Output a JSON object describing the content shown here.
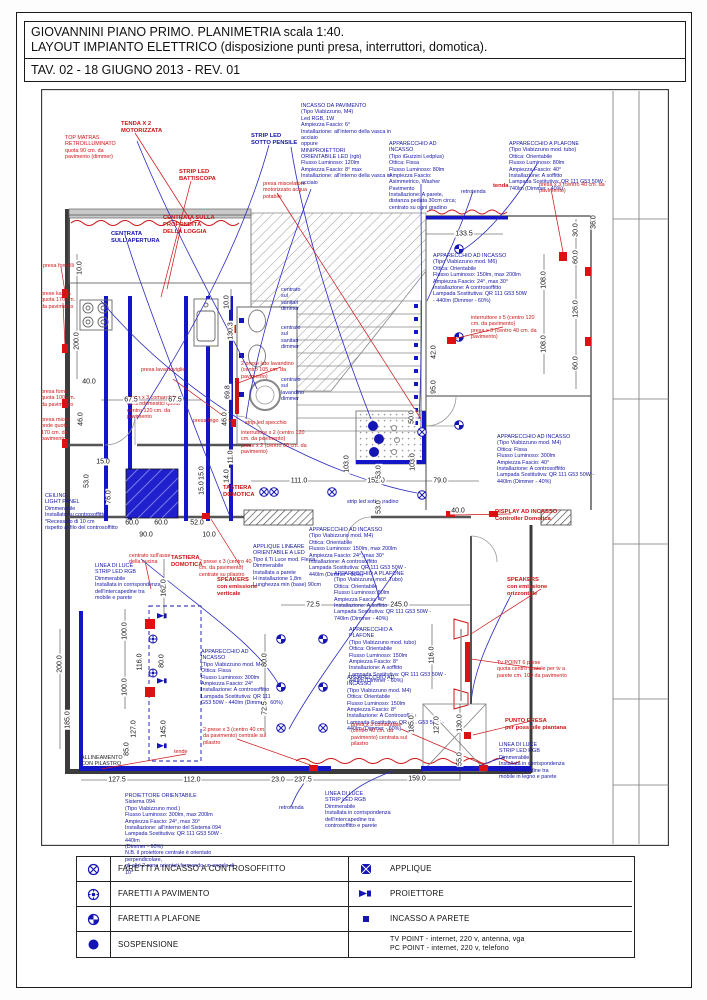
{
  "page": {
    "title_line1": "GIOVANNINI PIANO PRIMO. PLANIMETRIA scala 1:40.",
    "title_line2": "LAYOUT IMPIANTO ELETTRICO (disposizione punti presa, interruttori, domotica).",
    "title_line3": "TAV. 02 - 18 GIUGNO 2013 - REV. 01"
  },
  "colors": {
    "annotation_red": "#cc1414",
    "annotation_blue": "#1515a8",
    "strip_led_blue": "#1515c8",
    "wall_gray": "#4a4a4a"
  },
  "legend": {
    "rows": [
      {
        "symbol": "faretto-incasso-controsoffitto-icon",
        "label": "FARETTI A INCASSO A CONTROSOFFITTO"
      },
      {
        "symbol": "faretto-pavimento-icon",
        "label": "FARETTI A PAVIMENTO"
      },
      {
        "symbol": "faretto-plafone-icon",
        "label": "FARETTI A PLAFONE"
      },
      {
        "symbol": "sospensione-icon",
        "label": "SOSPENSIONE"
      },
      {
        "symbol": "applique-icon",
        "label": "APPLIQUE"
      },
      {
        "symbol": "proiettore-icon",
        "label": "PROIETTORE"
      },
      {
        "symbol": "incasso-parete-icon",
        "label": "INCASSO A PARETE"
      },
      {
        "symbol": "none",
        "label": "TV POINT - internet, 220 v, antenna, vga\nPC POINT - internet, 220 v, telefono"
      }
    ]
  },
  "plan": {
    "labels": [
      {
        "t": "TENDA X 2\nMOTORIZZATA",
        "x": 80,
        "y": 32,
        "c": "red b"
      },
      {
        "t": "STRIP LED\nBATTISCOPA",
        "x": 138,
        "y": 80,
        "c": "red b"
      },
      {
        "t": "TOP MATRAS\nRETROILLUMINATO\nquota 90 cm. da\npavimento (dimmer)",
        "x": 24,
        "y": 46,
        "c": "red"
      },
      {
        "t": "presa miscelatore\nmotorizzato acqua\npotabile",
        "x": 222,
        "y": 92,
        "c": "red"
      },
      {
        "t": "CENTRATA SULLA\nPROFONDITÀ\nDELLA LOGGIA",
        "x": 122,
        "y": 126,
        "c": "red b"
      },
      {
        "t": "CENTRATA\nSULL'APERTURA",
        "x": 70,
        "y": 142,
        "c": "blue b"
      },
      {
        "t": "STRIP LED\nSOTTO PENSILE",
        "x": 210,
        "y": 44,
        "c": "blue b"
      },
      {
        "t": "presa fornelli",
        "x": 2,
        "y": 174,
        "c": "red"
      },
      {
        "t": "prese kappa\nquota 170 cm.\nda pavimento",
        "x": 0,
        "y": 202,
        "c": "red"
      },
      {
        "t": "presa forno\nquota 100 cm.\nda pavimento",
        "x": 0,
        "y": 300,
        "c": "red"
      },
      {
        "t": "presa micro\nonde quota\n170 cm. da\npavimento",
        "x": 0,
        "y": 328,
        "c": "red"
      },
      {
        "t": "presa lavastoviglie",
        "x": 100,
        "y": 278,
        "c": "red"
      },
      {
        "t": "presa frigo",
        "x": 152,
        "y": 329,
        "c": "red"
      },
      {
        "t": "presa x 3 comandata\nelettrodomestici quota\ncentro 120 cm. da\npavimento",
        "x": 86,
        "y": 306,
        "c": "red"
      },
      {
        "t": "2 prese lato lavandino\n(centro 105 cm. da\npavimento)",
        "x": 200,
        "y": 272,
        "c": "red"
      },
      {
        "t": "strip led specchio",
        "x": 204,
        "y": 331,
        "c": "red"
      },
      {
        "t": "interruttore x 2 (centro 120\ncm. da pavimento)\nprese x 2 (centro 60 cm. da\npavimento)",
        "x": 200,
        "y": 341,
        "c": "red"
      },
      {
        "t": "centrato\nsul\nsanitari\ndimmer",
        "x": 240,
        "y": 198,
        "c": "blue"
      },
      {
        "t": "centrato\nsul\nsanitari\ndimmer",
        "x": 240,
        "y": 236,
        "c": "blue"
      },
      {
        "t": "centrato\nsul\nlavandino\ndimmer",
        "x": 240,
        "y": 288,
        "c": "blue"
      },
      {
        "t": "INCASSO DA PAVIMENTO\n(Tipo Viabizzuno, M4)\nLed RGB, 1W\nAmpiezza Fascio: 6°\nInstallazione: all'interno della vasca in\nacciaio\noppure\nMINIPROIETTORI\nORIENTABILE LED (rgb)\nFlusso Luminoso: 120lm\nAmpiezza Fascio: 8° max\nInstallazione: all'interno della vasca in\nacciaio",
        "x": 260,
        "y": 14,
        "c": "blue"
      },
      {
        "t": "APPARECCHIO AD\nINCASSO\n(Tipo iGuzzini Ledplus)\nOttica: Fissa\nFlusso Luminoso: 80lm\nAmpiezza Fascio:\nAsimmetrico, Washer\nPavimento\nInstallazione: A parete,\ndistanza pedata 30cm circa;\ncentrato su ogni gradino",
        "x": 348,
        "y": 52,
        "c": "blue"
      },
      {
        "t": "APPARECCHIO A PLAFONE\n(Tipo Viabizzuno mod. tubo)\nOttica: Orientabile\nFlusso Luminoso: 80lm\nAmpiezza Fascio: 40°\nInstallazione: A soffitto\nLampada Sostitutiva: QR 111 G53 50W - 740lm (Dimmer - 40%)",
        "x": 468,
        "y": 52,
        "c": "blue"
      },
      {
        "t": "retrotenda",
        "x": 420,
        "y": 100,
        "c": "blue"
      },
      {
        "t": "tenda",
        "x": 452,
        "y": 94,
        "c": "red b"
      },
      {
        "t": "presa x 3 (centro 40 cm. da\npavimento)",
        "x": 498,
        "y": 93,
        "c": "red"
      },
      {
        "t": "APPARECCHIO AD INCASSO\n(Tipo Viabizzuno mod. M6)\nOttica: Orientabile\nFlusso Luminoso: 150lm, max 200lm\nAmpiezza Fascio: 24°, max 30°\nInstallazione: A controsoffitto\nLampada Sostitutiva: QR 111 G53 50W\n- 440lm (Dimmer - 60%)",
        "x": 392,
        "y": 164,
        "c": "blue"
      },
      {
        "t": "interruttore x 5 (centro 120\ncm. da pavimento)\npresa x 3 (centro 40 cm. da\npavimento)",
        "x": 430,
        "y": 226,
        "c": "red"
      },
      {
        "t": "APPARECCHIO AD INCASSO\n(Tipo Viabizzuno mod. M4)\nOttica: Fissa\nFlusso Luminoso: 300lm\nAmpiezza Fascio: 40°\nInstallazione: A controsoffitto\nLampada Sostitutiva: QR 111 G53 50W - 440lm (Dimmer - 40%)",
        "x": 456,
        "y": 345,
        "c": "blue"
      },
      {
        "t": "strip led sotto gradino",
        "x": 306,
        "y": 410,
        "c": "blue"
      },
      {
        "t": "DISPLAY AD INCASSO\nController Domotica",
        "x": 454,
        "y": 420,
        "c": "red b"
      },
      {
        "t": "APPARECCHIO AD INCASSO\n(Tipo Viabizzuno mod. M4)\nOttica: Orientabile\nFlusso Luminoso: 150lm, max 200lm\nAmpiezza Fascio: 24°, max 30°\nInstallazione: A controsoffitto\nLampada Sostitutiva: QR 111 G53 50W - 440lm (Dimmer - 60%)",
        "x": 268,
        "y": 438,
        "c": "blue"
      },
      {
        "t": "APPLIQUE LINEARE\nORIENTABILE A LED\nTipo il.Ti Luce mod. Flexia\nDimmerabile\nInstallata a parete\nH installazione 1,8m\nLunghezza min (base) 90cm",
        "x": 212,
        "y": 455,
        "c": "blue"
      },
      {
        "t": "CEILING\nLIGHT PANEL\nDimmerabile\nInstallato su controsoffitto\n*Recessato di 10 cm\nrispetto al filo del controsoffitto",
        "x": 4,
        "y": 404,
        "c": "blue"
      },
      {
        "t": "LINEA DI LUCE\nSTRIP LED RGB\nDimmerabile\nInstallata in corrispondenza\ndell'intercapedine tra\nmobile e parete",
        "x": 54,
        "y": 474,
        "c": "blue"
      },
      {
        "t": "centrato sull'asse\ndella cucina",
        "x": 88,
        "y": 464,
        "c": "red"
      },
      {
        "t": "TASTIERA\nDOMOTICA",
        "x": 182,
        "y": 396,
        "c": "red b"
      },
      {
        "t": "TASTIERA\nDOMOTICA",
        "x": 130,
        "y": 466,
        "c": "red b"
      },
      {
        "t": "2 prese x 3 (centro 40\ncm. da pavimento)\ncentrate su pilastro",
        "x": 158,
        "y": 470,
        "c": "red"
      },
      {
        "t": "SPEAKERS\ncon emissione\nverticale",
        "x": 176,
        "y": 488,
        "c": "red b"
      },
      {
        "t": "APPARECCHIO A PLAFONE\n(Tipo Viabizzuno mod. Tubo)\nOttica: Orientabile\nFlusso Luminoso: 80lm\nAmpiezza Fascio: 40°\nInstallazione: A soffitto\nLampada Sostitutiva: QR 111 G53 50W - 740lm (Dimmer - 40%)",
        "x": 293,
        "y": 482,
        "c": "blue"
      },
      {
        "t": "APPARECCHIO A\nPLAFONE\n(Tipo Viabizzuno mod. tubo)\nOttica: Orientabile\nFlusso Luminoso: 150lm\nAmpiezza Fascio: 8°\nInstallazione: A soffitto\nLampada Sostitutiva: QR 111 G53 50W - 440lm (Dimmer - 60%)",
        "x": 308,
        "y": 538,
        "c": "blue"
      },
      {
        "t": "APPARECCHIO AD\nINCASSO\n(Tipo Viabizzuno mod. M4)\nOttica: Orientabile\nFlusso Luminoso: 150lm\nAmpiezza Fascio: 8°\nInstallazione: A Controsoffitto\nLampada Sostitutiva: QR 111 G53 50W - 440lm (Dimmer - 60%)",
        "x": 306,
        "y": 586,
        "c": "blue"
      },
      {
        "t": "APPARECCHIO AD\nINCASSO\n(Tipo Viabizzuno mod. M4)\nOttica: Fissa\nFlusso Luminoso: 300lm\nAmpiezza Fascio: 24°\nInstallazione: A controsoffitto\nLampada Sostitutiva: QR 111\nG53 50W - 440lm (Dimmer - 60%)",
        "x": 160,
        "y": 560,
        "c": "blue"
      },
      {
        "t": "SPEAKERS\ncon emissione\norizzontale",
        "x": 466,
        "y": 488,
        "c": "red b"
      },
      {
        "t": "Tv POINT 6 prese\nquota centro scatole per tv a\nparete cm. 100 da pavimento",
        "x": 456,
        "y": 571,
        "c": "red"
      },
      {
        "t": "PUNTO PRESA\nper possibile piantana",
        "x": 464,
        "y": 629,
        "c": "red b"
      },
      {
        "t": "LINEA DI LUCE\nSTRIP LED RGB\nDimmerabile\nInstallata in corrispondenza\ndell'intercapedine tra\nmobile in legno e parete",
        "x": 458,
        "y": 653,
        "c": "blue"
      },
      {
        "t": "presa x 3 comandate\n(centro 40 cm. da\npavimento) centrata sul\npilastro",
        "x": 310,
        "y": 633,
        "c": "red"
      },
      {
        "t": "2 prese x 3 (centro 40 cm.\nda pavimento) centrale sul\npilastro",
        "x": 162,
        "y": 638,
        "c": "red"
      },
      {
        "t": "tende",
        "x": 133,
        "y": 660,
        "c": "red"
      },
      {
        "t": "ALLINEAMENTO\nCON PILASTRO",
        "x": 40,
        "y": 666,
        "c": "black"
      },
      {
        "t": "PROIETTORE ORIENTABILE\nSistema 094\n(Tipo Viabizzuno mod.)\nFlusso Luminoso: 300lm, max 200lm\nAmpiezza Fascio: 24°, max 30°\nInstallazione: all'interno del Sistema 094\nLampada Sostitutiva: QR 111 G53 50W - 440lm\n(Dimmer - 60%)\nN.B. il proiettore centrale è orientato perpendicolare,\ngli altri 2 sono orientati formando un angolo di 10°",
        "x": 84,
        "y": 704,
        "c": "blue"
      },
      {
        "t": "retrotenda",
        "x": 238,
        "y": 716,
        "c": "blue"
      },
      {
        "t": "LINEA DI LUCE\nSTRIP LED RGB\nDimmerabile\nInstallata in corrispondenza\ndell'intercapedine tra\ncontrosoffitto e parete",
        "x": 284,
        "y": 702,
        "c": "blue"
      }
    ],
    "dims": [
      {
        "t": "10.0",
        "x": 39,
        "y": 179,
        "r": 1
      },
      {
        "t": "200.0",
        "x": 36,
        "y": 252,
        "r": 1
      },
      {
        "t": "40.0",
        "x": 48,
        "y": 293
      },
      {
        "t": "67.5",
        "x": 90,
        "y": 311
      },
      {
        "t": "67.5",
        "x": 134,
        "y": 311
      },
      {
        "t": "46.0",
        "x": 40,
        "y": 330,
        "r": 1
      },
      {
        "t": "46.0",
        "x": 184,
        "y": 330,
        "r": 1
      },
      {
        "t": "10.0",
        "x": 186,
        "y": 213,
        "r": 1
      },
      {
        "t": "130.3",
        "x": 190,
        "y": 242,
        "r": 1
      },
      {
        "t": "69.8",
        "x": 187,
        "y": 303,
        "r": 1
      },
      {
        "t": "11.0",
        "x": 190,
        "y": 368,
        "r": 1
      },
      {
        "t": "15.0",
        "x": 62,
        "y": 373
      },
      {
        "t": "53.0",
        "x": 46,
        "y": 392,
        "r": 1
      },
      {
        "t": "76.0",
        "x": 68,
        "y": 408,
        "r": 1
      },
      {
        "t": "60.0",
        "x": 91,
        "y": 434
      },
      {
        "t": "60.0",
        "x": 120,
        "y": 434
      },
      {
        "t": "90.0",
        "x": 105,
        "y": 446
      },
      {
        "t": "52.0",
        "x": 156,
        "y": 434
      },
      {
        "t": "10.0",
        "x": 168,
        "y": 446
      },
      {
        "t": "15.0",
        "x": 161,
        "y": 384,
        "r": 1
      },
      {
        "t": "15.0",
        "x": 161,
        "y": 399,
        "r": 1
      },
      {
        "t": "14.0",
        "x": 186,
        "y": 387,
        "r": 1
      },
      {
        "t": "111.0",
        "x": 258,
        "y": 392
      },
      {
        "t": "152.0",
        "x": 335,
        "y": 392
      },
      {
        "t": "79.0",
        "x": 399,
        "y": 392
      },
      {
        "t": "53.0",
        "x": 338,
        "y": 383,
        "r": 1
      },
      {
        "t": "53.0",
        "x": 338,
        "y": 418,
        "r": 1
      },
      {
        "t": "50.0",
        "x": 371,
        "y": 328,
        "r": 1
      },
      {
        "t": "103.0",
        "x": 372,
        "y": 373,
        "r": 1
      },
      {
        "t": "103.0",
        "x": 306,
        "y": 375,
        "r": 1
      },
      {
        "t": "95.0",
        "x": 393,
        "y": 298,
        "r": 1
      },
      {
        "t": "42.0",
        "x": 393,
        "y": 263,
        "r": 1
      },
      {
        "t": "133.5",
        "x": 423,
        "y": 145
      },
      {
        "t": "30.0",
        "x": 535,
        "y": 141,
        "r": 1
      },
      {
        "t": "60.0",
        "x": 535,
        "y": 168,
        "r": 1
      },
      {
        "t": "126.0",
        "x": 535,
        "y": 220,
        "r": 1
      },
      {
        "t": "60.0",
        "x": 535,
        "y": 274,
        "r": 1
      },
      {
        "t": "108.0",
        "x": 503,
        "y": 191,
        "r": 1
      },
      {
        "t": "108.0",
        "x": 503,
        "y": 255,
        "r": 1
      },
      {
        "t": "36.0",
        "x": 553,
        "y": 133,
        "r": 1
      },
      {
        "t": "40.0",
        "x": 417,
        "y": 422
      },
      {
        "t": "162.0",
        "x": 123,
        "y": 499,
        "r": 1
      },
      {
        "t": "100.0",
        "x": 84,
        "y": 542,
        "r": 1
      },
      {
        "t": "116.0",
        "x": 99,
        "y": 573,
        "r": 1
      },
      {
        "t": "80.0",
        "x": 121,
        "y": 572,
        "r": 1
      },
      {
        "t": "100.0",
        "x": 84,
        "y": 598,
        "r": 1
      },
      {
        "t": "200.0",
        "x": 19,
        "y": 575,
        "r": 1
      },
      {
        "t": "185.0",
        "x": 27,
        "y": 631,
        "r": 1
      },
      {
        "t": "127.0",
        "x": 93,
        "y": 640,
        "r": 1
      },
      {
        "t": "145.0",
        "x": 123,
        "y": 640,
        "r": 1
      },
      {
        "t": "85.0",
        "x": 86,
        "y": 660,
        "r": 1
      },
      {
        "t": "72.5",
        "x": 272,
        "y": 516
      },
      {
        "t": "245.0",
        "x": 358,
        "y": 516
      },
      {
        "t": "80.0",
        "x": 224,
        "y": 571,
        "r": 1
      },
      {
        "t": "72.5",
        "x": 224,
        "y": 619,
        "r": 1
      },
      {
        "t": "116.0",
        "x": 391,
        "y": 566,
        "r": 1
      },
      {
        "t": "185.0",
        "x": 371,
        "y": 635,
        "r": 1
      },
      {
        "t": "127.0",
        "x": 396,
        "y": 636,
        "r": 1
      },
      {
        "t": "130.0",
        "x": 419,
        "y": 634,
        "r": 1
      },
      {
        "t": "55.0",
        "x": 419,
        "y": 670,
        "r": 1
      },
      {
        "t": "127.5",
        "x": 76,
        "y": 691
      },
      {
        "t": "112.0",
        "x": 151,
        "y": 691
      },
      {
        "t": "23.0",
        "x": 237,
        "y": 691
      },
      {
        "t": "237.5",
        "x": 262,
        "y": 691
      },
      {
        "t": "159.0",
        "x": 376,
        "y": 690
      }
    ]
  }
}
